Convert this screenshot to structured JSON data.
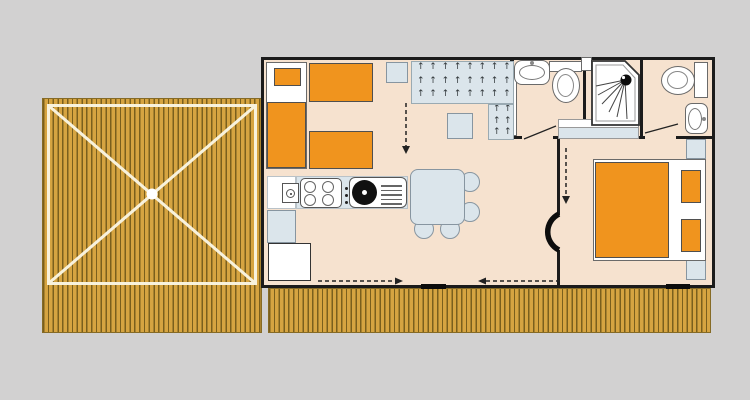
{
  "meta": {
    "title": "Mobile home floor plan with covered wooden terrace",
    "diagram_type": "floor-plan",
    "visible_text": "none"
  },
  "palette": {
    "background": "#d2d1d1",
    "deck_base": "#d6a441",
    "deck_stripe": "#7a5f1d",
    "deck_frame": "#f8f2dd",
    "floor": "#f6e2cf",
    "furniture_orange": "#f0941e",
    "furniture_blue": "#dbe5eb",
    "blue_border": "#8795a0",
    "wall": "#1b1b1b",
    "line": "#3a3a3a",
    "white": "#ffffff"
  },
  "areas": {
    "terrace_deck": {
      "name": "covered terrace deck",
      "features": [
        "wood planking",
        "canopy shown as X diagonals",
        "center pole dot",
        "cream border frame"
      ]
    },
    "front_boardwalk": {
      "name": "boardwalk strip along facade",
      "features": [
        "wood planking"
      ]
    },
    "bedroom_1": {
      "name": "bedroom with single beds",
      "furniture": [
        "single bed with orange pillow",
        "single bed",
        "single bed",
        "nightstand",
        "textured wardrobe area",
        "stool table"
      ]
    },
    "bathroom": {
      "name": "shower room",
      "furniture": [
        "washbasin",
        "toilet with cistern",
        "shower cabin with spray head",
        "shelf unit",
        "sliding door panel"
      ]
    },
    "wc": {
      "name": "separate WC",
      "furniture": [
        "toilet with cistern",
        "washbasin"
      ]
    },
    "bedroom_2": {
      "name": "double bedroom",
      "furniture": [
        "double bed",
        "pillow",
        "pillow",
        "nightstand",
        "nightstand"
      ]
    },
    "living_kitchen": {
      "name": "living room with kitchenette",
      "furniture": [
        "kitchen counter",
        "4-burner hob",
        "control knobs",
        "round sink with drainer",
        "water heater",
        "low cabinet",
        "fridge",
        "dining table",
        "chair",
        "chair",
        "chair",
        "chair"
      ]
    }
  },
  "texture": {
    "glyph": "↑",
    "color": "#2f3538",
    "main_grid": {
      "cols": 8,
      "rows": 3
    },
    "column_grid": {
      "cols": 2,
      "rows": 3
    }
  },
  "circulation": {
    "dashed_arrows": [
      "bedroom-1 to living (down)",
      "corridor to bedroom-2 (down)",
      "deck entry pointing right",
      "deck entry pointing left"
    ],
    "door_swings": [
      "bathroom",
      "wc",
      "bedroom-2 (black arc)"
    ],
    "thresholds": 2
  }
}
